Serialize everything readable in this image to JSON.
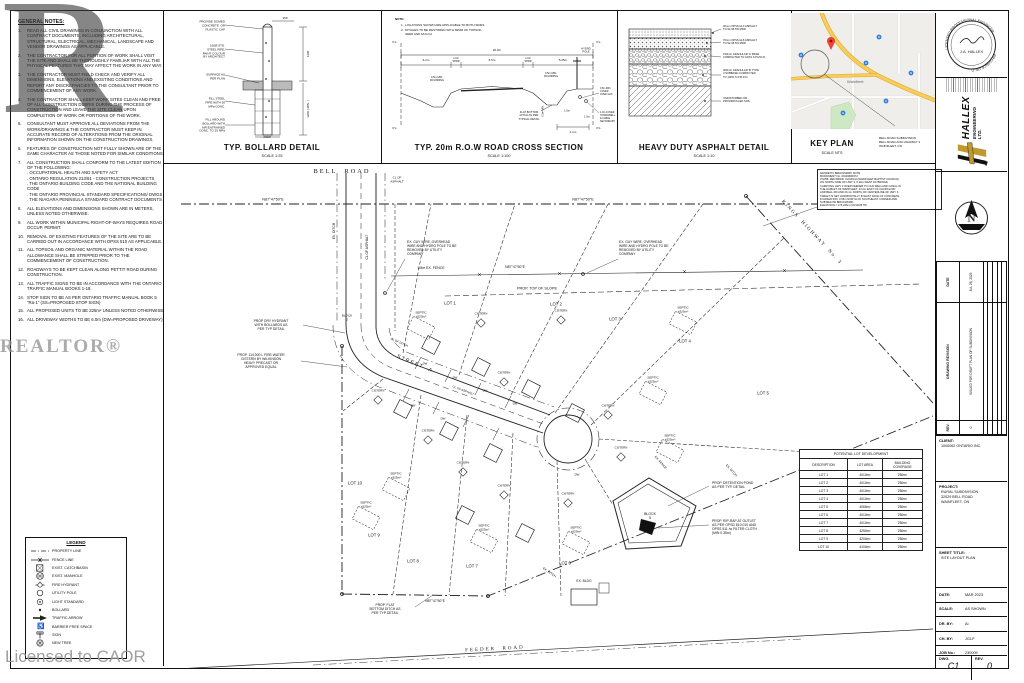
{
  "watermarks": {
    "letter": "R",
    "brand": "REALTOR®",
    "license": "Licensed to CAOR"
  },
  "general_notes": {
    "title": "GENERAL NOTES:",
    "items": [
      "READ ALL CIVIL DRAWINGS IN CONJUNCTION WITH ALL CONTRACT DOCUMENTS, INCLUDING ARCHITECTURAL, STRUCTURAL, ELECTRICAL, MECHANICAL, LANDSCAPE AND VENDOR DRAWINGS AS APPLICABLE.",
      "THE CONTRACTOR FOR ALL PORTION OF WORK SHALL VISIT THE SITE AND SHALL BE THOROUGHLY FAMILIAR WITH ALL THE PHYSICAL FEATURES THAT MAY AFFECT THE WORK IN ANY WAY.",
      "THE CONTRACTOR MUST FIELD CHECK AND VERIFY ALL DIMENSIONS, ELEVATIONS AND EXISTING CONDITIONS AND REPORT ANY DISCREPANCIES TO THE CONSULTANT PRIOR TO COMMENCEMENT OF ANY WORK.",
      "THE CONTRACTOR SHALL KEEP WORK SITES CLEAN AND FREE OF ALL CONSTRUCTION DEBRIS DURING THE PROCESS OF CONSTRUCTION AND LEAVE THE SITE CLEAN UPON COMPLETION OF WORK OR PORTIONS OF THE WORK.",
      "CONSULTANT MUST APPROVE ALL DEVIATIONS FROM THE WORK/DRAWINGS & THE CONTRACTOR MUST KEEP IN ACCURATE RECORD OF ALTERATIONS FROM THE ORIGINAL INFORMATION SHOWN ON THE CONSTRUCTION DRAWINGS.",
      "FEATURES OF CONSTRUCTION NOT FULLY SHOWN ARE OF THE SAME CHARACTER AS THOSE NOTED FOR SIMILAR CONDITIONS.",
      "ALL CONSTRUCTION SHALL CONFORM TO THE LATEST EDITION OF THE FOLLOWING:\n. OCCUPATIONAL HEALTH AND SAFETY ACT\n. ONTARIO REGULATION 213/91 - CONSTRUCTION PROJECTS\n. THE ONTARIO BUILDING CODE AND THE NATIONAL BUILDING CODE\n. THE ONTARIO PROVINCIAL STANDARD SPECIFICATIONS/ DWGS\n. THE NIAGARA PENINSULA STANDARD CONTRACT DOCUMENTS",
      "ALL ELEVATIONS AND DIMENSIONS SHOWN ARE IN METERS, UNLESS NOTED OTHERWISE.",
      "ALL WORK WITHIN MUNICIPAL RIGHT-OF-WAYS REQUIRES ROAD OCCUP. PERMIT.",
      "REMOVAL OF EXISTING FEATURES OF THE SITE ARE TO BE CARRIED OUT IN ACCORDANCE WITH OPSS 510 AS APPLICABLE.",
      "ALL TOPSOIL AND ORGANIC MATERIAL WITHIN THE ROAD ALLOWANCE SHALL BE STRIPPED PRIOR TO THE COMMENCEMENT OF CONSTRUCTION.",
      "ROADWAYS TO BE KEPT CLEAN ALONG PETTIT ROAD DURING CONSTRUCTION.",
      "ALL TRAFFIC SIGNS TO BE IN ACCORDANCE WITH THE ONTARIO TRAFFIC MANUAL BOOKS 1-18.",
      "STOP SIGN TO BE AS PER ONTARIO TRAFFIC MANUAL BOOK 5 \"Ra-1\" (SS=PROPOSED STOP SIGN)",
      "ALL PROPOSED UNITS TO BE 225m² UNLESS NOTED OTHERWISE",
      "ALL DRIVEWAY WIDTHS TO BE 6.0m (DW=PROPOSED DRIVEWAY)"
    ]
  },
  "legend": {
    "title": "LEGEND",
    "items": [
      {
        "icon": "property-line-symbol",
        "label": "PROPERTY LINE"
      },
      {
        "icon": "fence-line-symbol",
        "label": "FENCE LINE"
      },
      {
        "icon": "catchbasin-symbol",
        "label": "EXIST. CATCHBASIN"
      },
      {
        "icon": "manhole-symbol",
        "label": "EXIST. MANHOLE"
      },
      {
        "icon": "fire-hydrant-symbol",
        "label": "FIRE HYDRANT"
      },
      {
        "icon": "utility-pole-symbol",
        "label": "UTILITY POLE"
      },
      {
        "icon": "light-standard-symbol",
        "label": "LIGHT STANDARD"
      },
      {
        "icon": "bollard-symbol",
        "label": "BOLLARD"
      },
      {
        "icon": "traffic-arrow-symbol",
        "label": "TRAFFIC ARROW"
      },
      {
        "icon": "barrier-free-symbol",
        "label": "BARRIER FREE SPACE"
      },
      {
        "icon": "sign-symbol",
        "label": "SIGN"
      },
      {
        "icon": "new-tree-symbol",
        "label": "NEW TREE"
      }
    ]
  },
  "details": {
    "bollard": {
      "title": "TYP. BOLLARD DETAIL",
      "scale": "SCALE 1:25",
      "callout_cap": "PROVIDE DOMED\nCONCRETE  OR\nPLASTIC CAP",
      "callout_pipe": "150Ø STD.\nSTEEL PIPE,\nPAINT COLOUR\nBY ARCHITECT",
      "callout_surface": "SURFACE AS\nPER PLAN",
      "callout_fill": "FILL STEEL\nPIPE WITH 30\nMPa CONC.",
      "callout_around": "FILL AROUND\nBOLLARD WITH\nAIR ENTRAINED\nCONC. TO 25 MPa",
      "dim_150": "150",
      "dim_1200": "1200",
      "dim_1200min": "1200 ( MIN. )",
      "dim_200": "200Ø"
    },
    "cross_section": {
      "title": "TYP. 20m R.O.W ROAD CROSS SECTION",
      "scale": "SCALE 1:100",
      "note_title": "NOTE:",
      "note1": "1.  LOCATIONS SHOWN ARE APPLICABLE TO BOTH SIDES",
      "note2": "2.  DITCHES TO BE RESTORED WITH 50MM OF TOPSOIL\n     SEED AND MULCH",
      "pl": "P.L.",
      "dim_total": "20.0m",
      "dim_left": "5.2m",
      "dim_shdr": "1.0m\nSHDR",
      "dim_lane": "6.5m",
      "dim_shdr2": "1.0m\nSHDR",
      "dim_right": "5.25m",
      "rounding_left": "0.5m MIN.\nROUNDING",
      "rounding_right": "0.5m MIN.\nROUNDING",
      "hydro_pole": "HYDRO\nPOLE",
      "ditch_note": "FLAT BOTTOM\nDITCH AS PER\nTYPICAL DETAIL",
      "dim_21": "2.1m",
      "dim_15": "1.5m",
      "dim_10": "1.0m",
      "dim_05": "0.5m MIN.",
      "gas_note": "0.5m MIN.\nCOVER\nOVER GAS",
      "cable_note": "1.0m COVER\nHYDRO/BELL\n& CABLE\nSECONDARY"
    },
    "asphalt": {
      "title": "HEAVY DUTY ASPHALT DETAIL",
      "scale": "SCALE 1:10",
      "layer1": "40mm OPSS HL3 ASPHALT\nTO 92-96.5% MRD",
      "layer2": "70mm OPSS HL8 ASPHALT\nTO 92-96.5% MRD",
      "layer3": "150mm GRANULAR 'A' BASE\nCOMPACTED TO 100% S.P.M.D.D.",
      "layer4": "300mm GRANULAR 'B' TYPE\nII SUBBASE COMPACTED\nTO 100% S.P.M.D.D.",
      "layer5": "UNDISTURBED OR\nPROOFROLLED SOIL"
    },
    "keyplan": {
      "title": "KEY PLAN",
      "scale": "SCALE NTS",
      "town": "Wainfleet",
      "callout": "BELL ROAD SUBDIVISION\nBELL ROAD AND HIGHWAY 3\nWAINFLEET, ON"
    }
  },
  "plan": {
    "bell_road": "BELL  ROAD",
    "cl_of_asphalt": "CL OF\nASPHALT",
    "cl_asphalt_line": "CL OF ASPHALT",
    "cl_ditch": "CL OF DITCH",
    "ex_ditch": "EX. DITCH",
    "ex_fence": "1.8m EX. FENCE",
    "ex_fence_s": "EX. FENCE",
    "bearing": "N87°47'50\"E",
    "street_a": "STREET  A",
    "kings_highway": "KINGS  HIGHWAY  No. 3",
    "feeder_road": "FEEDER  ROAD",
    "guy_note": "EX. GUY WIRE, OVERHEAD\nWIRE AND HYDRO POLE TO BE\nREMOVED BY UTILITY\nCOMPANY",
    "top_of_slope": "PROP. TOP OF SLOPE",
    "dry_hydrant_note": "PROP DRY HYDRANT\nWITH BOLLARDS AS\nPER TYP DETAIL",
    "fire_cistern_note": "PROP. 114,000 L FIRE WATER\nCISTERN BY WILKINSON\nHEAVY PRECAST OR\nAPPROVED EQUAL",
    "detention_note": "PROP. DETENTION POND\nAS PER TYP. DETAIL",
    "riprap_note": "PROP. RIP-RAP AT OUTLET\nAS PER OPSD 810.010 AND\nOPSS 511 /w FILTER CLOTH\n(MIN 0.35m)",
    "flat_ditch_note": "PROP. FLAT\nBOTTOM DITCH AS\nPER TYP DETAIL",
    "ex_bldg": "EX. BLDG",
    "septic": "SEPTIC\n±525m²",
    "cistern": "CISTERN",
    "dw": "DW",
    "block2": "BLOCK\n2",
    "block5": "BLOCK\n5",
    "lots": [
      "LOT 1",
      "LOT 2",
      "LOT 3",
      "LOT 4",
      "LOT 5",
      "LOT 6",
      "LOT 7",
      "LOT 8",
      "LOT 9",
      "LOT 10"
    ],
    "benchmark": "GEODETIC BENCHMARK NOTE\nMONUMENT No. 00119680372\n372/88: RED BRICK CHURCH (WAINFLEET BAPTIST CHURCH)\nON NORTH SIDE OF HWY 3, 0.2km WEST OF BRIDGE\nCARRYING HWY 3 OVER FEEDER TO OLD WELLAND CANAL IN\nTHE HAMLET OF WAINFLEET, 13.2m EAST OF CHURCH RD\nAND BELL RD AND 26.1m NORTH OF CENTERLINE OF HWY 3.\nTABLET IS SET HORIZONTALLY IN EAST FACE OF CONCRETE\nFOUNDATION, 3.56m NORTH OF SOUTHEAST CORNER AND\nSUB BELOW BRICKWORK.\nELEVATION = 176.226m (CGVD28:78)",
    "table": {
      "title": "POTENTIAL LOT DEVELOPMENT",
      "columns": [
        "DESCRIPTION",
        "LOT AREA",
        "BUILDING\nCOVERAGE"
      ],
      "rows": [
        [
          "LOT 1",
          "4010m²",
          "250m²"
        ],
        [
          "LOT 2",
          "4010m²",
          "250m²"
        ],
        [
          "LOT 3",
          "4010m²",
          "250m²"
        ],
        [
          "LOT 4",
          "4010m²",
          "250m²"
        ],
        [
          "LOT 5",
          "4065m²",
          "250m²"
        ],
        [
          "LOT 6",
          "4010m²",
          "250m²"
        ],
        [
          "LOT 7",
          "4010m²",
          "250m²"
        ],
        [
          "LOT 8",
          "4250m²",
          "250m²"
        ],
        [
          "LOT 9",
          "4200m²",
          "250m²"
        ],
        [
          "LOT 10",
          "4100m²",
          "250m²"
        ]
      ]
    }
  },
  "titleblock": {
    "seal_top": "LICENSED PROFESSIONAL ENGINEER",
    "seal_name": "J.A. HALLEX",
    "seal_bottom": "PROVINCE OF ONTARIO",
    "company_name": "HALLEX",
    "company_sub": "ENGINEERING LTD.",
    "rev_headers": [
      "REV.",
      "DRAWING REVISION",
      "DATE"
    ],
    "rev_no": "0",
    "rev_desc": "ISSUED FOR DRAFT PLAN OF SUBDIVISION",
    "rev_date": "JUL 26, 2023",
    "client_label": "CLIENT:",
    "client": "1000062 ONTARIO INC.",
    "project_label": "PROJECT:",
    "project": "RURAL SUBDIVISION\n32029 BELL ROAD\nWAINFLEET, ON",
    "sheet_title_label": "SHEET TITLE:",
    "sheet_title": "SITE LAYOUT PLAN",
    "fields": [
      [
        "DATE:",
        "MAR 2023"
      ],
      [
        "SCALE:",
        "AS SHOWN"
      ],
      [
        "DR. BY:",
        "AI"
      ],
      [
        "CH. BY:",
        "JGLP"
      ],
      [
        "JOB No.:",
        "230009"
      ]
    ],
    "dwg_label": "DWG.",
    "rev_label": "REV.",
    "dwg_no": "C1",
    "rev_val": "0",
    "accent_gold": "#c09a2e"
  }
}
